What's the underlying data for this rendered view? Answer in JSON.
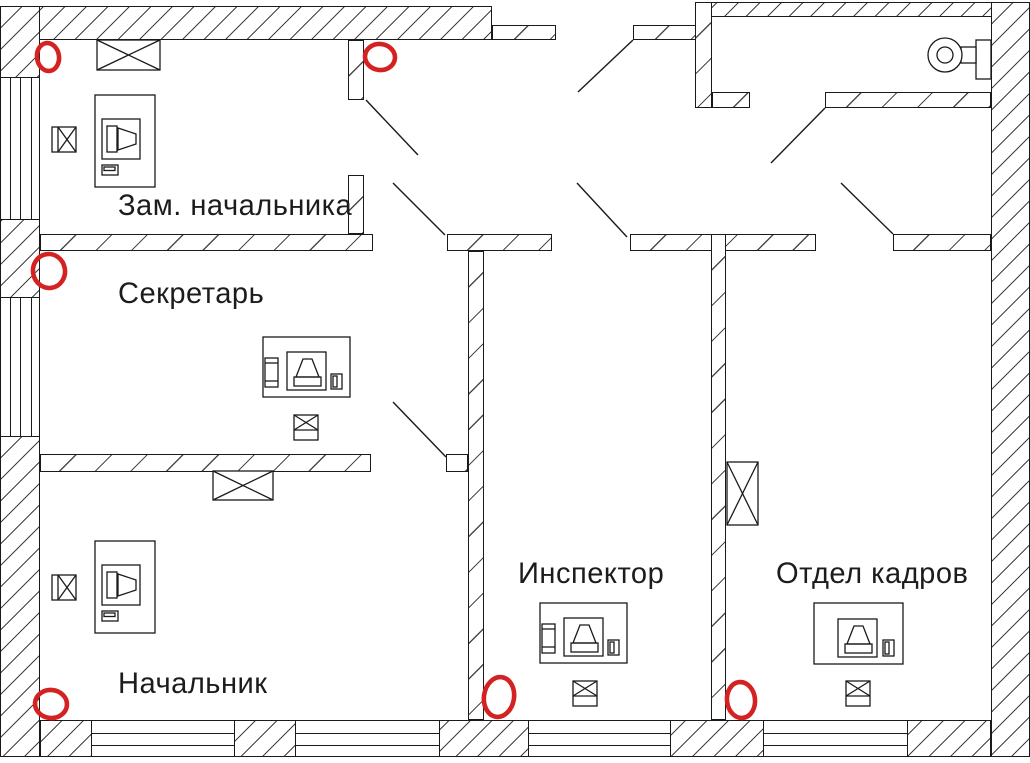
{
  "drawing": {
    "kind": "office floor plan",
    "rooms": [
      {
        "label": "Зам. начальника"
      },
      {
        "label": "Секретарь"
      },
      {
        "label": "Начальник"
      },
      {
        "label": "Инспектор"
      },
      {
        "label": "Отдел кадров"
      }
    ],
    "symbols": {
      "workstation": "desk with computer monitor, system unit and mouse",
      "cabinet": "crossed rectangle (wall cabinet / vent grille)",
      "socket": "small crossed square box",
      "fan": "wall-mounted fan in entrance hall",
      "window": "wall opening with glazing lines",
      "door": "swing leaf line"
    },
    "annotations": {
      "shape": "hand-drawn red circle",
      "count": 6,
      "color": "#d42222"
    },
    "colors": {
      "line": "#1a1a1a",
      "annotation": "#d42222",
      "background": "#ffffff"
    }
  }
}
